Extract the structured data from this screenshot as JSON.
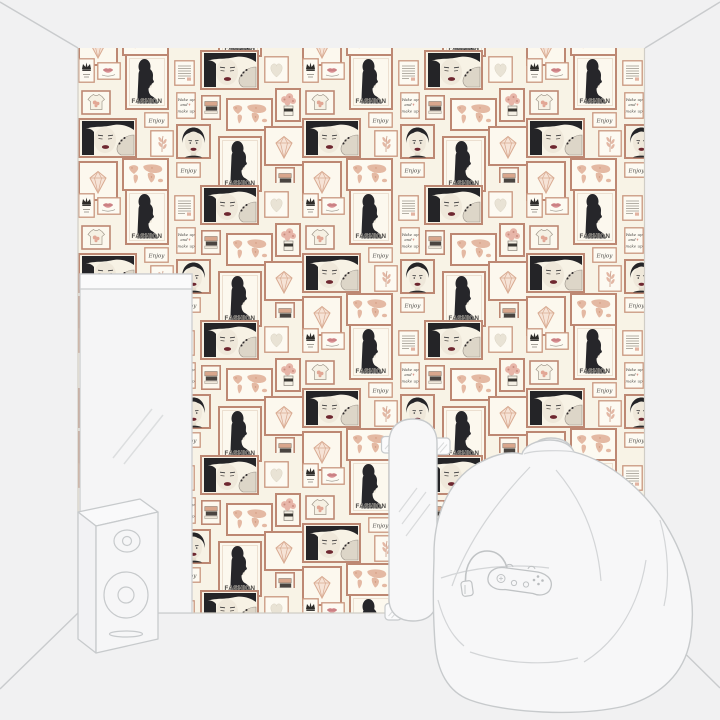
{
  "wallpaper": {
    "texts": {
      "fashion": "FASHION",
      "enjoy": "Enjoy",
      "wake_line1": "Wake up",
      "wake_line2": "and",
      "wake_line3": "make up"
    },
    "motifs": [
      "fashion-profile-portrait-frame",
      "woman-face-with-hand-frame",
      "woman-frontal-portrait-frame",
      "world-map-frame",
      "diamond-frame",
      "heart-frame",
      "crown-frame",
      "rose-bouquet-jar-frame",
      "t-shirt-frame",
      "book-stack-frame",
      "text-page-frame",
      "lips-frame",
      "enjoy-script-frame",
      "wake-up-and-make-up-script-frame",
      "leaf-sprig-frame"
    ],
    "colors": {
      "background": "#f8f3e6",
      "frame_border": "#bd8873",
      "frame_mat": "#e8d9c9",
      "portrait": "#26262a",
      "skin": "#efe8da",
      "lips": "#6e2730",
      "map_pink": "#e4b9a3",
      "heart_beige": "#e9e3d5"
    }
  },
  "room": {
    "objects": [
      "leaning-mirror",
      "skateboard",
      "loudspeaker",
      "bean-bag",
      "headphones",
      "game-controller"
    ],
    "colors": {
      "wall_gray": "#f1f1f2",
      "line_gray": "#c7cacc",
      "object_fill": "#f7f7f8"
    }
  }
}
